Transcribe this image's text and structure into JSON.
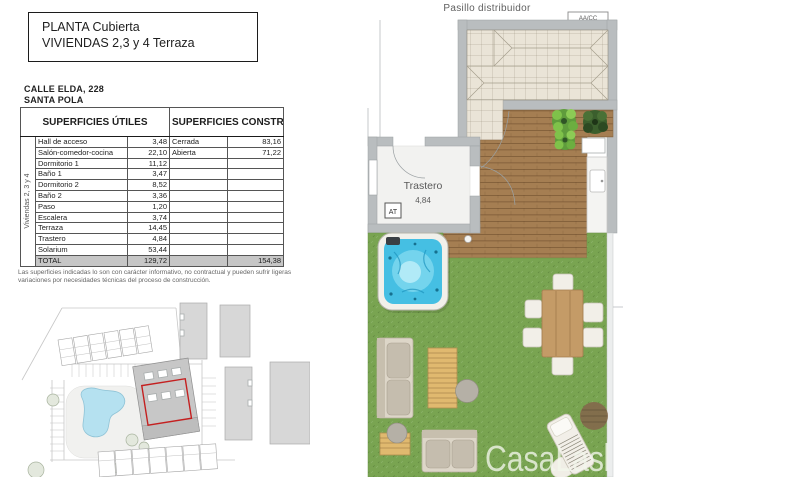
{
  "title_block": {
    "line1": "PLANTA Cubierta",
    "line2": "VIVIENDAS 2,3 y 4 Terraza"
  },
  "address": {
    "line1": "CALLE ELDA, 228",
    "line2": "SANTA POLA"
  },
  "surfaces_table": {
    "useful_header": "SUPERFICIES ÚTILES",
    "built_header": "SUPERFICIES CONSTRUIDAS",
    "group_label": "Viviendas 2, 3 y 4",
    "rows": [
      {
        "name": "Hall de acceso",
        "value": "3,48",
        "built_name": "Cerrada",
        "built_value": "83,16"
      },
      {
        "name": "Salón-comedor-cocina",
        "value": "22,10",
        "built_name": "Abierta",
        "built_value": "71,22"
      },
      {
        "name": "Dormitorio 1",
        "value": "11,12"
      },
      {
        "name": "Baño 1",
        "value": "3,47"
      },
      {
        "name": "Dormitorio 2",
        "value": "8,52"
      },
      {
        "name": "Baño 2",
        "value": "3,36"
      },
      {
        "name": "Paso",
        "value": "1,20"
      },
      {
        "name": "Escalera",
        "value": "3,74"
      },
      {
        "name": "Terraza",
        "value": "14,45"
      },
      {
        "name": "Trastero",
        "value": "4,84"
      },
      {
        "name": "Solarium",
        "value": "53,44"
      }
    ],
    "total": {
      "label": "TOTAL",
      "useful": "129,72",
      "built": "154,38"
    }
  },
  "disclaimer": "Las superficies indicadas lo son con carácter informativo, no contractual y pueden sufrir ligeras variaciones por necesidades técnicas del proceso de construcción.",
  "floor_plan": {
    "corridor_label": "Pasillo distribuidor",
    "ac_unit_label": "AA/CC",
    "at_label": "AT",
    "room_label": "Trastero",
    "room_area": "4,84",
    "watermark": "CasaLas"
  },
  "palette": {
    "wall": "#b9bdbf",
    "roof": "#eae4d7",
    "deck": "#a57e52",
    "grass": "#79a451",
    "water": "#45bfe3",
    "wood": "#c49b67",
    "lightwood": "#e0b96f",
    "cushion": "#c5bdae",
    "furn": "#f2efe8",
    "red": "#c42020"
  }
}
